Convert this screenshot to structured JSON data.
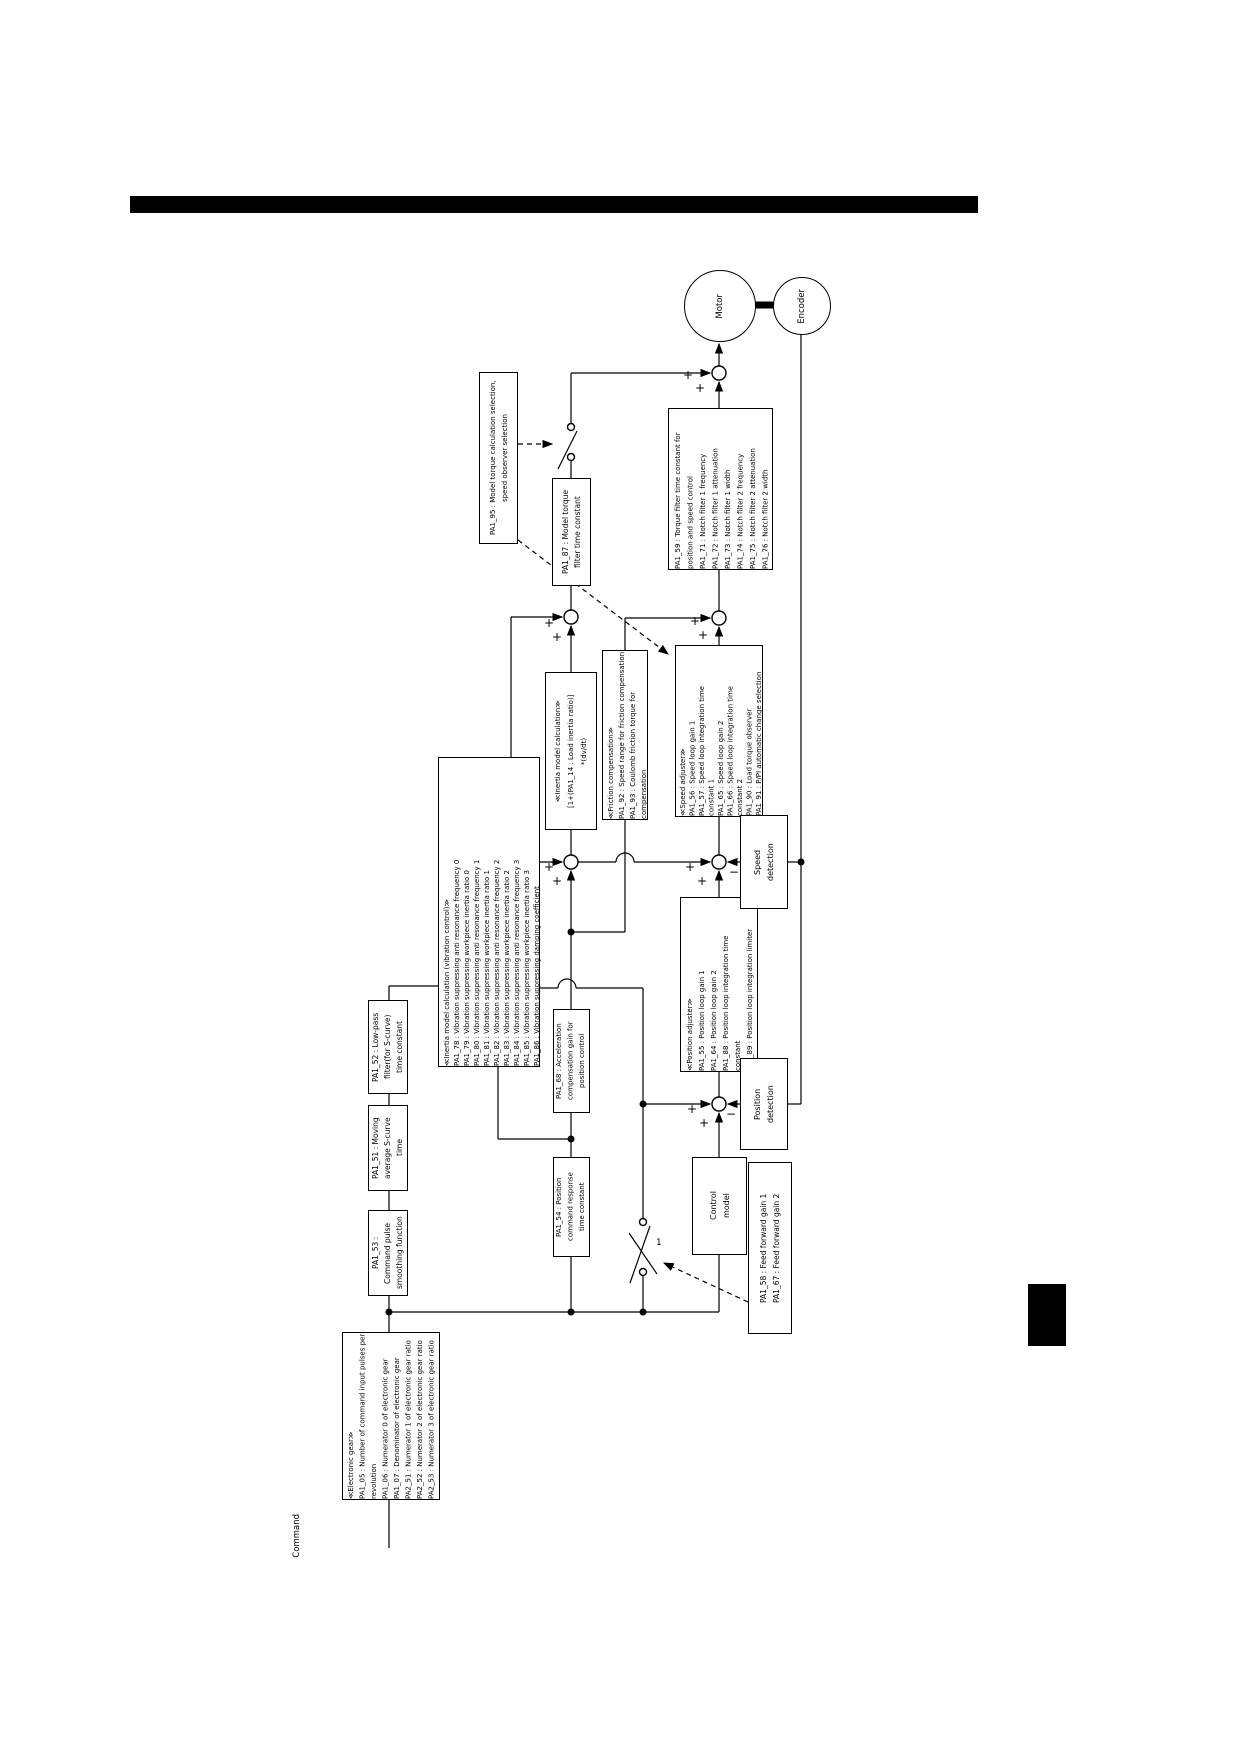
{
  "circles": {
    "motor": "Motor",
    "encoder": "Encoder"
  },
  "labels": {
    "command": "Command",
    "switch_contact": "1",
    "plus": "+",
    "minus": "−"
  },
  "boxes": {
    "pa95": {
      "lines": [
        "PA1_95 : Model torque calculation selection,",
        "speed observer selection"
      ]
    },
    "pa87": {
      "lines": [
        "PA1_87 : Model torque",
        "filter time constant"
      ]
    },
    "notch": {
      "lines": [
        "PA1_59 : Torque filter time constant for",
        "position and speed control",
        "PA1_71 : Notch filter 1 frequency",
        "PA1_72 : Notch filter 1 attenuation",
        "PA1_73 : Notch filter 1 width",
        "PA1_74 : Notch filter 2 frequency",
        "PA1_75 : Notch filter 2 attenuation",
        "PA1_76 : Notch filter 2 width"
      ]
    },
    "inertia_calc": {
      "lines": [
        "≪Inertia model calculation≫",
        "[1+(PA1_14 : Load inertia ratio)]",
        "*(dv/dt)"
      ]
    },
    "friction": {
      "lines": [
        "≪Friction compensation≫",
        "PA1_92 : Speed range for friction compensation",
        "PA1_93 : Coulomb friction torque for",
        "compensation"
      ]
    },
    "speed_adjuster": {
      "lines": [
        "≪Speed adjuster≫",
        "PA1_56 : Speed loop gain 1",
        "PA1_57 : Speed loop integration time",
        "constant 1",
        "PA1_65 : Speed loop gain 2",
        "PA1_66 : Speed loop integration time",
        "constant 2",
        "PA1_90 : Load torque observer",
        "PA1_91 : P/PI automatic change selection"
      ]
    },
    "vibration": {
      "lines": [
        "≪Inertia model calculation (vibration control)≫",
        "PA1_78 : Vibration suppressing anti resonance frequency 0",
        "PA1_79 : Vibration suppressing workpiece inertia ratio 0",
        "PA1_80 : Vibration suppressing anti resonance frequency 1",
        "PA1_81 : Vibration suppressing workpiece inertia ratio 1",
        "PA1_82 : Vibration suppressing anti resonance frequency 2",
        "PA1_83 : Vibration suppressing workpiece inertia ratio 2",
        "PA1_84 : Vibration suppressing anti resonance frequency 3",
        "PA1_85 : Vibration suppressing workpiece inertia ratio 3",
        "PA1_86 : Vibration suppressing damping coefficient"
      ]
    },
    "position_adjuster": {
      "lines": [
        "≪Position adjuster≫",
        "PA1_55 : Position loop gain 1",
        "PA1_64 : Position loop gain 2",
        "PA1_88 : Position loop integration time",
        "constant",
        "PA1_89 : Position loop integration limiter"
      ]
    },
    "pa68": {
      "lines": [
        "PA1_68 : Acceleration",
        "compensation gain for",
        "position control"
      ]
    },
    "pa54": {
      "lines": [
        "PA1_54 : Position",
        "command response",
        "time constant"
      ]
    },
    "pa52": {
      "lines": [
        "PA1_52 : Low-pass",
        "filter(for S-curve)",
        "time constant"
      ]
    },
    "pa51": {
      "lines": [
        "PA1_51 : Moving",
        "average S-curve",
        "time"
      ]
    },
    "pa53": {
      "lines": [
        "PA1_53 :",
        "Command pulse",
        "smoothing function"
      ]
    },
    "electronic_gear": {
      "lines": [
        "≪Electronic gear≫",
        "PA1_05 : Number of command input pulses per",
        "revolution",
        "PA1_06 : Numerator 0 of electronic gear",
        "PA1_07 : Denominator of electronic gear",
        "PA2_51 : Numerator 1 of electronic gear ratio",
        "PA2_52 : Numerator 2 of electronic gear ratio",
        "PA2_53 : Numerator 3 of electronic gear ratio"
      ]
    },
    "speed_detection": {
      "lines": [
        "Speed",
        "detection"
      ]
    },
    "position_detection": {
      "lines": [
        "Position",
        "detection"
      ]
    },
    "control_model": {
      "lines": [
        "Control",
        "model"
      ]
    },
    "feed_forward": {
      "lines": [
        "PA1_58 : Feed forward gain 1",
        "PA1_67 : Feed forward gain 2"
      ]
    }
  }
}
